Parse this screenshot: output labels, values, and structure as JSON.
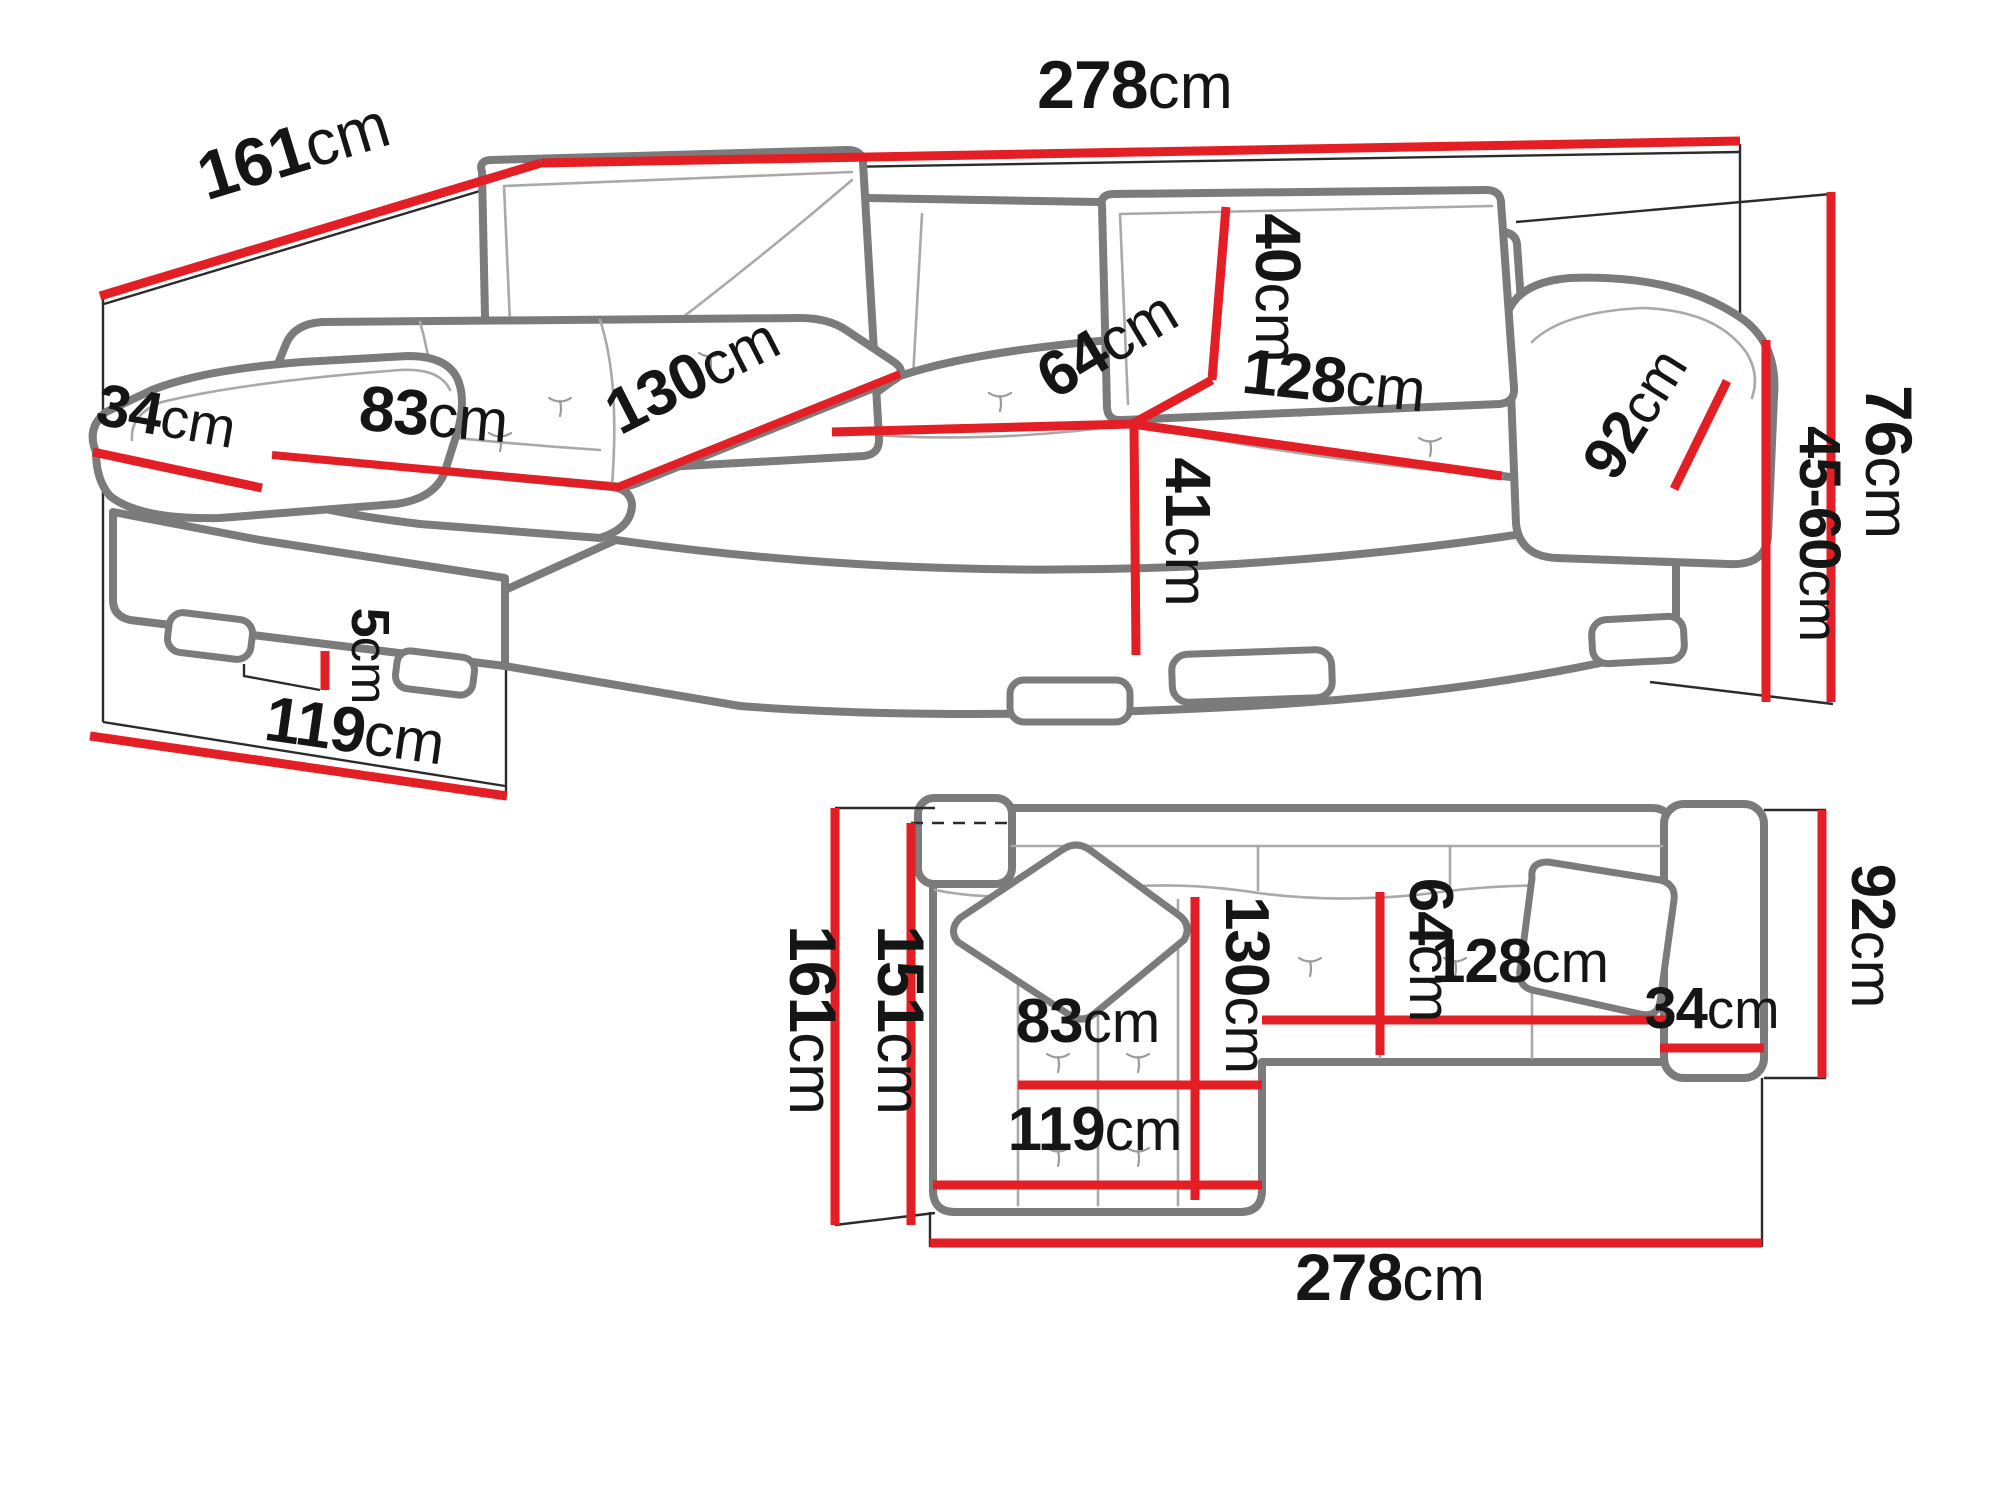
{
  "diagram": {
    "subject": "corner-sofa-dimensions",
    "views": {
      "perspective": "perspective-view",
      "plan": "top-plan-view"
    }
  },
  "colors": {
    "dimension_red": "#e31e24",
    "outline_gray": "#7b7b7b",
    "seam_gray": "#a9a9a9",
    "text_black": "#151515",
    "background": "#ffffff"
  },
  "persp": {
    "d161": {
      "num": "161",
      "unit": "cm"
    },
    "d278": {
      "num": "278",
      "unit": "cm"
    },
    "d40": {
      "num": "40",
      "unit": "cm"
    },
    "d64": {
      "num": "64",
      "unit": "cm"
    },
    "d128": {
      "num": "128",
      "unit": "cm"
    },
    "d92": {
      "num": "92",
      "unit": "cm"
    },
    "d76": {
      "num": "76",
      "unit": "cm"
    },
    "d4560": {
      "num": "45-60",
      "unit": "cm"
    },
    "d34": {
      "num": "34",
      "unit": "cm"
    },
    "d83": {
      "num": "83",
      "unit": "cm"
    },
    "d130": {
      "num": "130",
      "unit": "cm"
    },
    "d41": {
      "num": "41",
      "unit": "cm"
    },
    "d5": {
      "num": "5",
      "unit": "cm"
    },
    "d119": {
      "num": "119",
      "unit": "cm"
    }
  },
  "plan": {
    "d161": {
      "num": "161",
      "unit": "cm"
    },
    "d151": {
      "num": "151",
      "unit": "cm"
    },
    "d130": {
      "num": "130",
      "unit": "cm"
    },
    "d64": {
      "num": "64",
      "unit": "cm"
    },
    "d128": {
      "num": "128",
      "unit": "cm"
    },
    "d34": {
      "num": "34",
      "unit": "cm"
    },
    "d92": {
      "num": "92",
      "unit": "cm"
    },
    "d83": {
      "num": "83",
      "unit": "cm"
    },
    "d119": {
      "num": "119",
      "unit": "cm"
    },
    "d278": {
      "num": "278",
      "unit": "cm"
    }
  }
}
